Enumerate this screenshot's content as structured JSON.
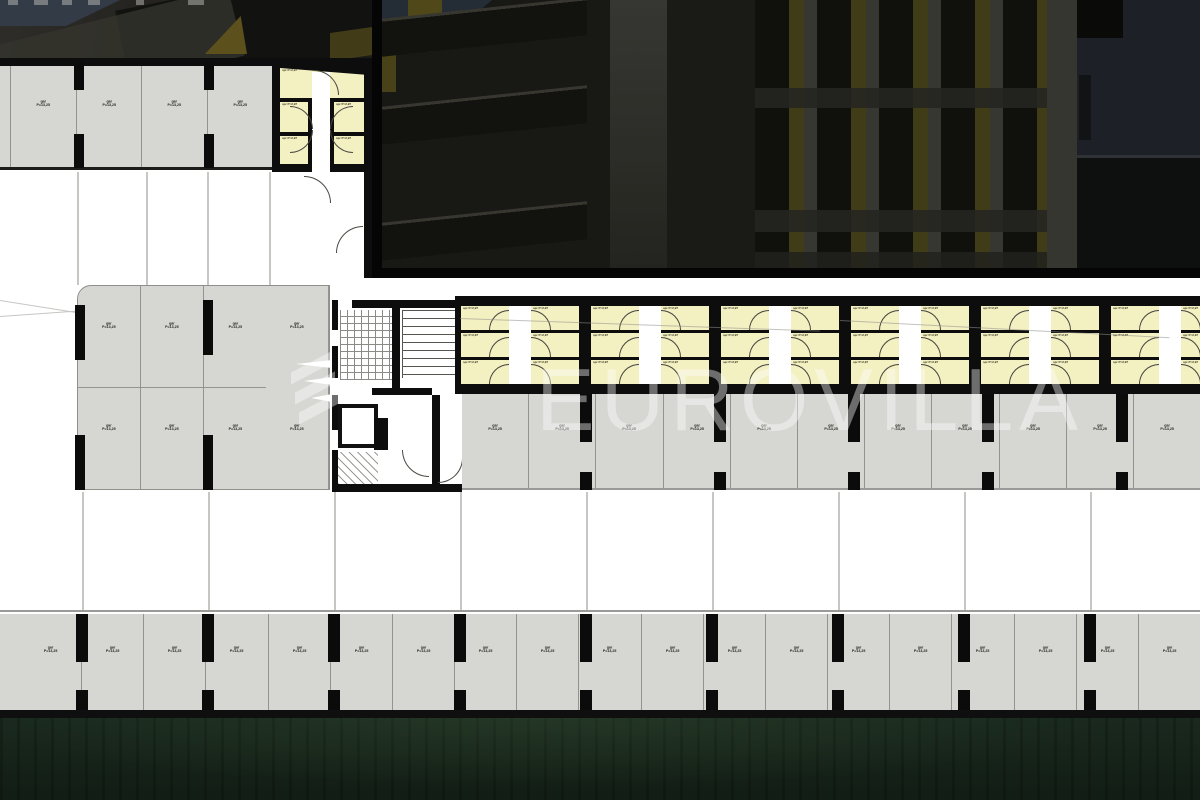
{
  "watermark": {
    "text": "EUROVILLA"
  },
  "labels": {
    "parking": {
      "line1": "gar",
      "line2": "P=13,25"
    },
    "storage": {
      "line1": "spr",
      "line2": "P=2,97"
    }
  },
  "bands": {
    "top_row": {
      "count": 4
    },
    "left_block": {
      "count": 8
    },
    "storage_units": {
      "count": 6
    },
    "mid_row": {
      "count": 11
    },
    "bottom_row": {
      "count": 19
    }
  },
  "colors": {
    "storage_yellow": "#f3f0c2",
    "parking_gray": "#d6d6d3",
    "wall_black": "#0d0d0d",
    "grass_green": "#1a291e",
    "watermark_white": "rgba(255,255,255,0.40)"
  }
}
